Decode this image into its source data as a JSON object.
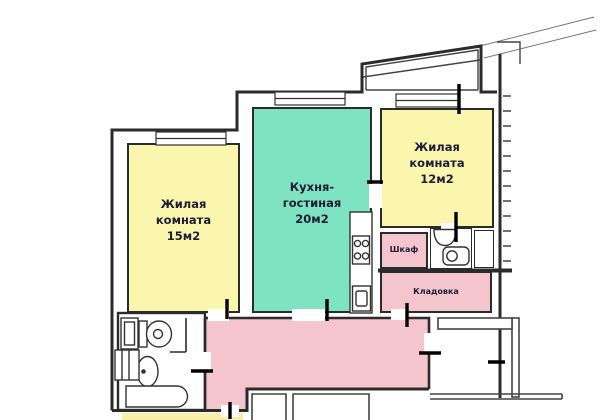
{
  "plan": {
    "background": "#ffffff",
    "wall_color": "#2b2b2b",
    "door_mark_color": "#000000",
    "rooms": {
      "living1": {
        "name_line1": "Жилая",
        "name_line2": "комната",
        "area": "15м2",
        "color": "#fbf6ae"
      },
      "kitchen": {
        "name_line1": "Кухня-",
        "name_line2": "гостиная",
        "area": "20м2",
        "color": "#7de3c0"
      },
      "living2": {
        "name_line1": "Жилая",
        "name_line2": "комната",
        "area": "12м2",
        "color": "#fbf6ae"
      },
      "shkaf": {
        "name": "Шкаф",
        "color": "#f5c5cd"
      },
      "kladovka": {
        "name": "Кладовка",
        "color": "#f5c5cd"
      },
      "hallway": {
        "color": "#f5c5cd"
      },
      "wc": {
        "color": "#ffffff"
      },
      "bathroom": {
        "color": "#ffffff"
      },
      "neighbor_strip": {
        "color": "#f8f0a4"
      }
    },
    "fixtures": {
      "kitchen": [
        "stove-icon",
        "kitchen-sink-icon"
      ],
      "wc": [
        "washbasin-icon",
        "toilet-icon"
      ],
      "bathroom": [
        "toilet-icon",
        "sink-icon",
        "bathtub-icon",
        "vent-shaft-icon",
        "washing-box-icon"
      ]
    }
  }
}
